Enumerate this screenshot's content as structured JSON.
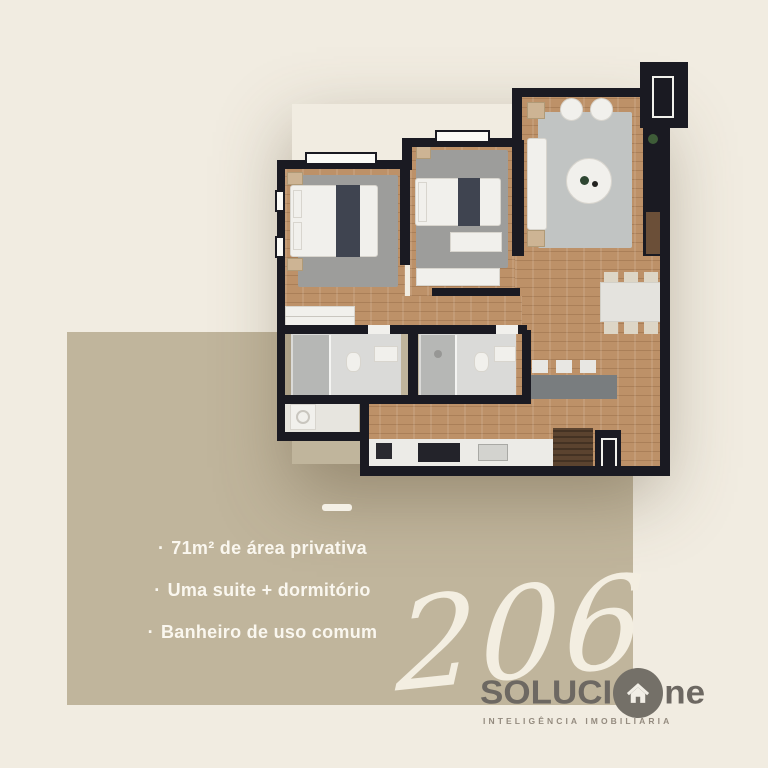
{
  "colors": {
    "background": "#f1ece1",
    "panel": "#c0b59c",
    "wall": "#1a1a22",
    "wood": "#bd9168",
    "rug": "#9d9d9b",
    "living-rug": "#c1c4c3",
    "tile": "#dadad8",
    "accent-white": "#f6f2e8",
    "logo-text": "#6d6862",
    "logo-circle": "#747068",
    "tagline": "#948b7f",
    "island": "#797d7f",
    "bed-throw": "#3f4450",
    "entry-brown": "#5b432f"
  },
  "features": {
    "items": [
      {
        "bullet": "·",
        "label": "71m² de área privativa"
      },
      {
        "bullet": "·",
        "label": "Uma suite + dormitório"
      },
      {
        "bullet": "·",
        "label": "Banheiro de uso comum"
      }
    ]
  },
  "unit": {
    "number": "206"
  },
  "logo": {
    "prefix": "SOLUCI",
    "suffix": "ne",
    "icon": "house-icon",
    "tagline": "INTELIGÊNCIA IMOBILIÁRIA"
  }
}
